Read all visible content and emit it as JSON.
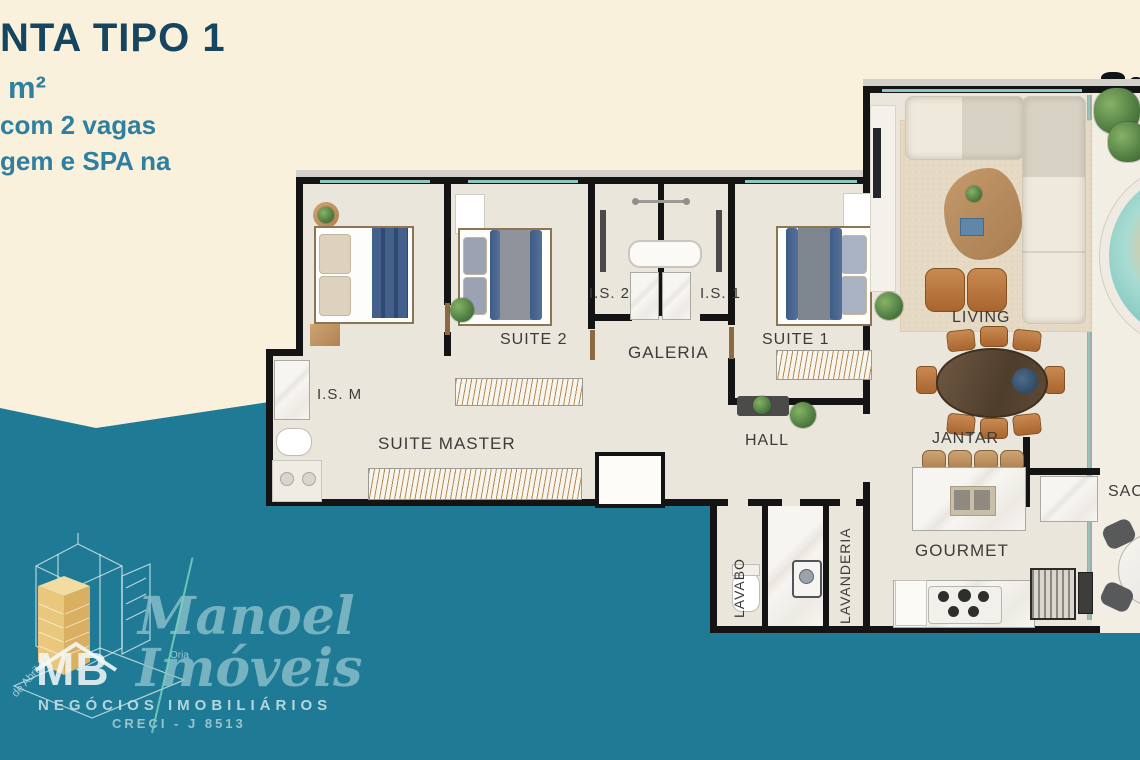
{
  "colors": {
    "cream": "#FAF1DC",
    "teal": "#1F7B95",
    "floor": "#EBE6DC",
    "wall": "#141414",
    "glass": "#8FC7BE",
    "label": "#3B3B3B",
    "title": "#16465F",
    "accent": "#2E7FA0",
    "logotext": "#8CC0CB",
    "gold": "#E9C87D"
  },
  "header": {
    "title": "NTA TIPO 1",
    "area_unit": "m²",
    "line2": "com 2 vagas",
    "line3": "gem e SPA na"
  },
  "labels": {
    "suite_master": "SUITE MASTER",
    "suite_2": "SUITE 2",
    "suite_1": "SUITE 1",
    "is_2": "I.S. 2",
    "is_1": "I.S. 1",
    "is_m": "I.S. M",
    "galeria": "GALERIA",
    "hall": "HALL",
    "living": "LIVING",
    "jantar": "JANTAR",
    "gourmet": "GOURMET",
    "lavabo": "LAVABO",
    "lavanderia": "LAVANDERIA",
    "sacada": "SAC"
  },
  "logo": {
    "monogram": "MB",
    "brand_line1": "Manoel",
    "brand_line2": "Imóveis",
    "small_label": "Oria",
    "building_note": "de Abril",
    "tagline": "NEGÓCIOS IMOBILIÁRIOS",
    "creci": "CRECI - J 8513"
  }
}
